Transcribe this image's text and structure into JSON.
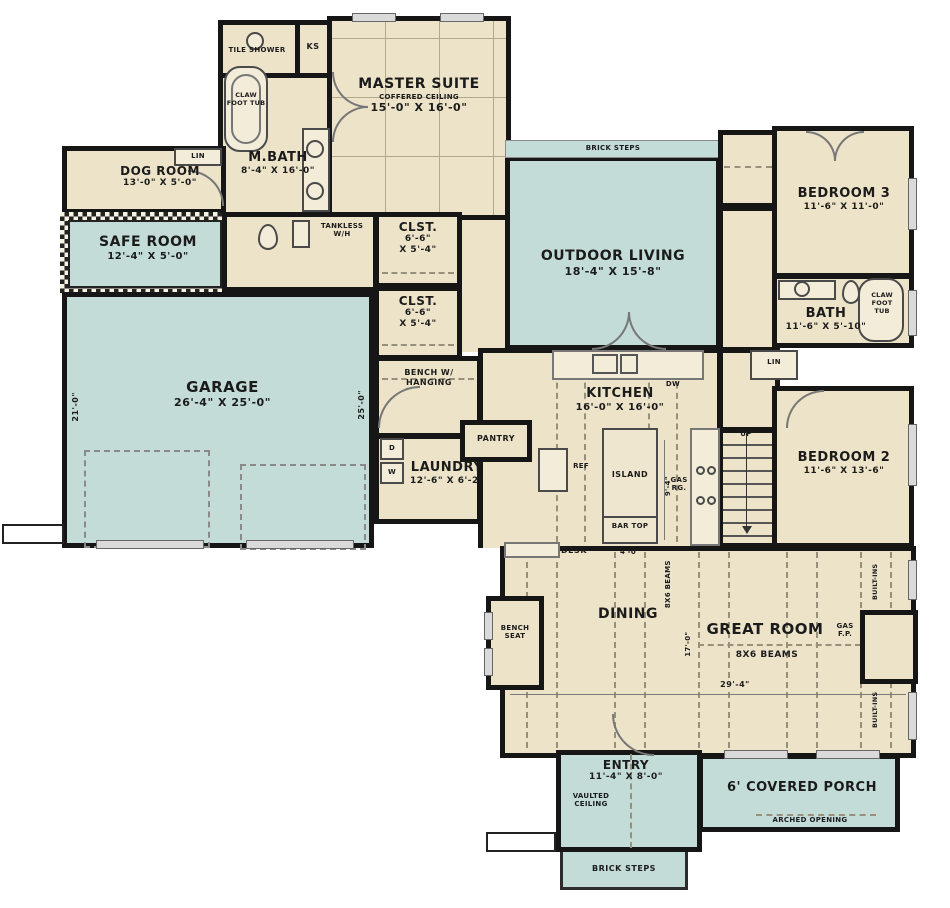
{
  "colors": {
    "interior": "#ece3c8",
    "outdoor": "#c3dcd7",
    "wall": "#161616"
  },
  "rooms": {
    "master_suite": {
      "label": "MASTER SUITE",
      "ceiling": "COFFERED CEILING",
      "dims": "15'-0\" X 16'-0\""
    },
    "master_bath": {
      "label": "M.BATH",
      "dims": "8'-4\" X 16'-0\""
    },
    "tile_shower": {
      "label": "TILE SHOWER"
    },
    "ks": {
      "label": "KS"
    },
    "master_tub": {
      "label": "CLAW FOOT TUB"
    },
    "dog_room": {
      "label": "DOG ROOM",
      "dims": "13'-0\" X 5'-0\""
    },
    "dog_lin": {
      "label": "LIN"
    },
    "safe_room": {
      "label": "SAFE ROOM",
      "dims": "12'-4\" X 5'-0\""
    },
    "tankless": {
      "label": "TANKLESS W/H"
    },
    "closet1": {
      "label": "CLST.",
      "dim1": "6'-6\"",
      "dim2": "X 5'-4\""
    },
    "closet2": {
      "label": "CLST.",
      "dim1": "6'-6\"",
      "dim2": "X 5'-4\""
    },
    "outdoor_living": {
      "label": "OUTDOOR LIVING",
      "dims": "18'-4\" X 15'-8\""
    },
    "brick_steps_top": {
      "label": "BRICK STEPS"
    },
    "bedroom3": {
      "label": "BEDROOM 3",
      "dims": "11'-6\" X 11'-0\""
    },
    "bath": {
      "label": "BATH",
      "dims": "11'-6\" X 5'-10\"",
      "tub": "CLAW FOOT TUB"
    },
    "hall_lin": {
      "label": "LIN"
    },
    "garage": {
      "label": "GARAGE",
      "dims": "26'-4\" X 25'-0\"",
      "dim_left": "21'-0\"",
      "dim_right": "25'-0\""
    },
    "bench_hanging": {
      "label": "BENCH W/ HANGING"
    },
    "pantry": {
      "label": "PANTRY"
    },
    "laundry": {
      "label": "LAUNDRY",
      "dims": "12'-6\" X 6'-2\"",
      "dryer": "D",
      "washer": "W"
    },
    "kitchen": {
      "label": "KITCHEN",
      "dims": "16'-0\" X 16'-0\"",
      "island": "ISLAND",
      "island_dim": "9'-4\"",
      "bar_top": "BAR TOP",
      "bar_dim": "4'-0\"",
      "ref": "REF",
      "dw": "DW",
      "range": "GAS RG.",
      "desk": "DESK"
    },
    "stairs": {
      "label": "UP"
    },
    "bedroom2": {
      "label": "BEDROOM 2",
      "dims": "11'-6\" X 13'-6\""
    },
    "dining": {
      "label": "DINING"
    },
    "bench_seat": {
      "label": "BENCH SEAT"
    },
    "great_room": {
      "label": "GREAT ROOM",
      "beams": "8X6 BEAMS",
      "beams_vertical": "8X6 BEAMS",
      "fireplace": "GAS F.P.",
      "dim_width": "29'-4\"",
      "dim_height": "17'-0\"",
      "builtins": "BUILT-INS"
    },
    "entry": {
      "label": "ENTRY",
      "dims": "11'-4\" X 8'-0\"",
      "ceiling": "VAULTED CEILING"
    },
    "porch": {
      "label": "6' COVERED PORCH",
      "arched": "ARCHED OPENING"
    },
    "brick_steps_bottom": {
      "label": "BRICK STEPS"
    }
  }
}
